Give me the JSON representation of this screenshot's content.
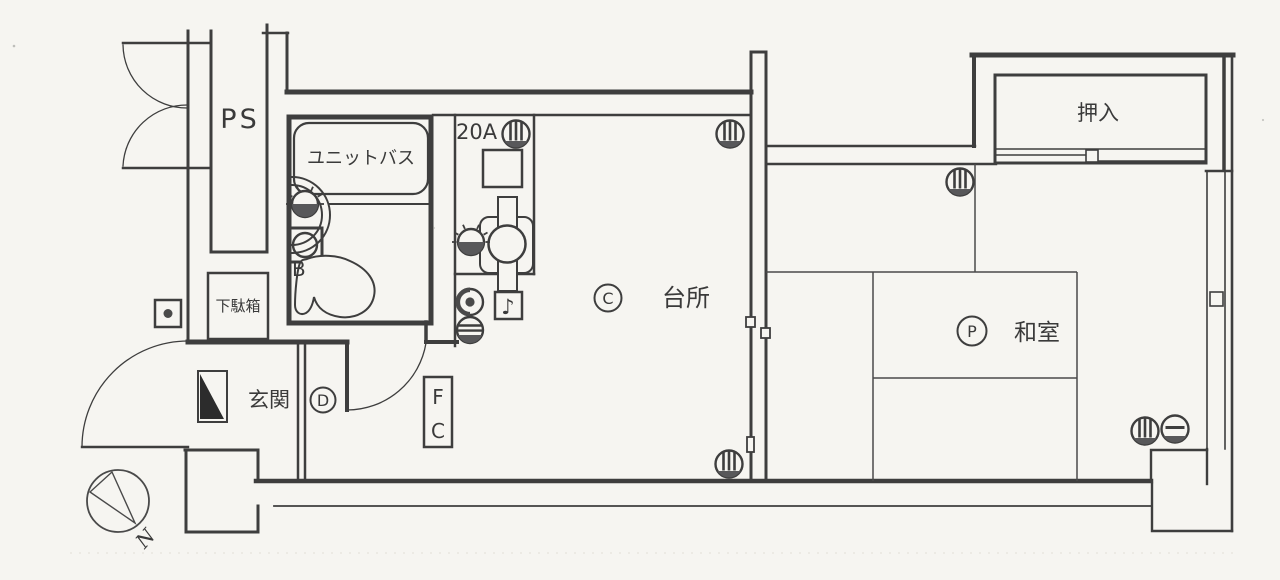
{
  "palette": {
    "paper": "#f6f5f1",
    "ink": "#3e3e3e",
    "dark_fill": "#58585a"
  },
  "rooms": {
    "ps": {
      "label": "PS"
    },
    "unit_bath": {
      "label": "ユニットバス",
      "point_mark": "B"
    },
    "kitchen": {
      "label": "台所",
      "circle_mark": "C",
      "breaker_label": "20A"
    },
    "washitsu": {
      "label": "和室",
      "circle_mark": "P"
    },
    "oshiire": {
      "label": "押入"
    },
    "genkan": {
      "label": "玄関",
      "circle_mark": "D",
      "shoe_cabinet_label": "下駄箱"
    }
  },
  "annotations": {
    "equipment_box_top": "F",
    "equipment_box_bottom": "C",
    "compass_north": "N",
    "door_chime_note": "♪"
  }
}
